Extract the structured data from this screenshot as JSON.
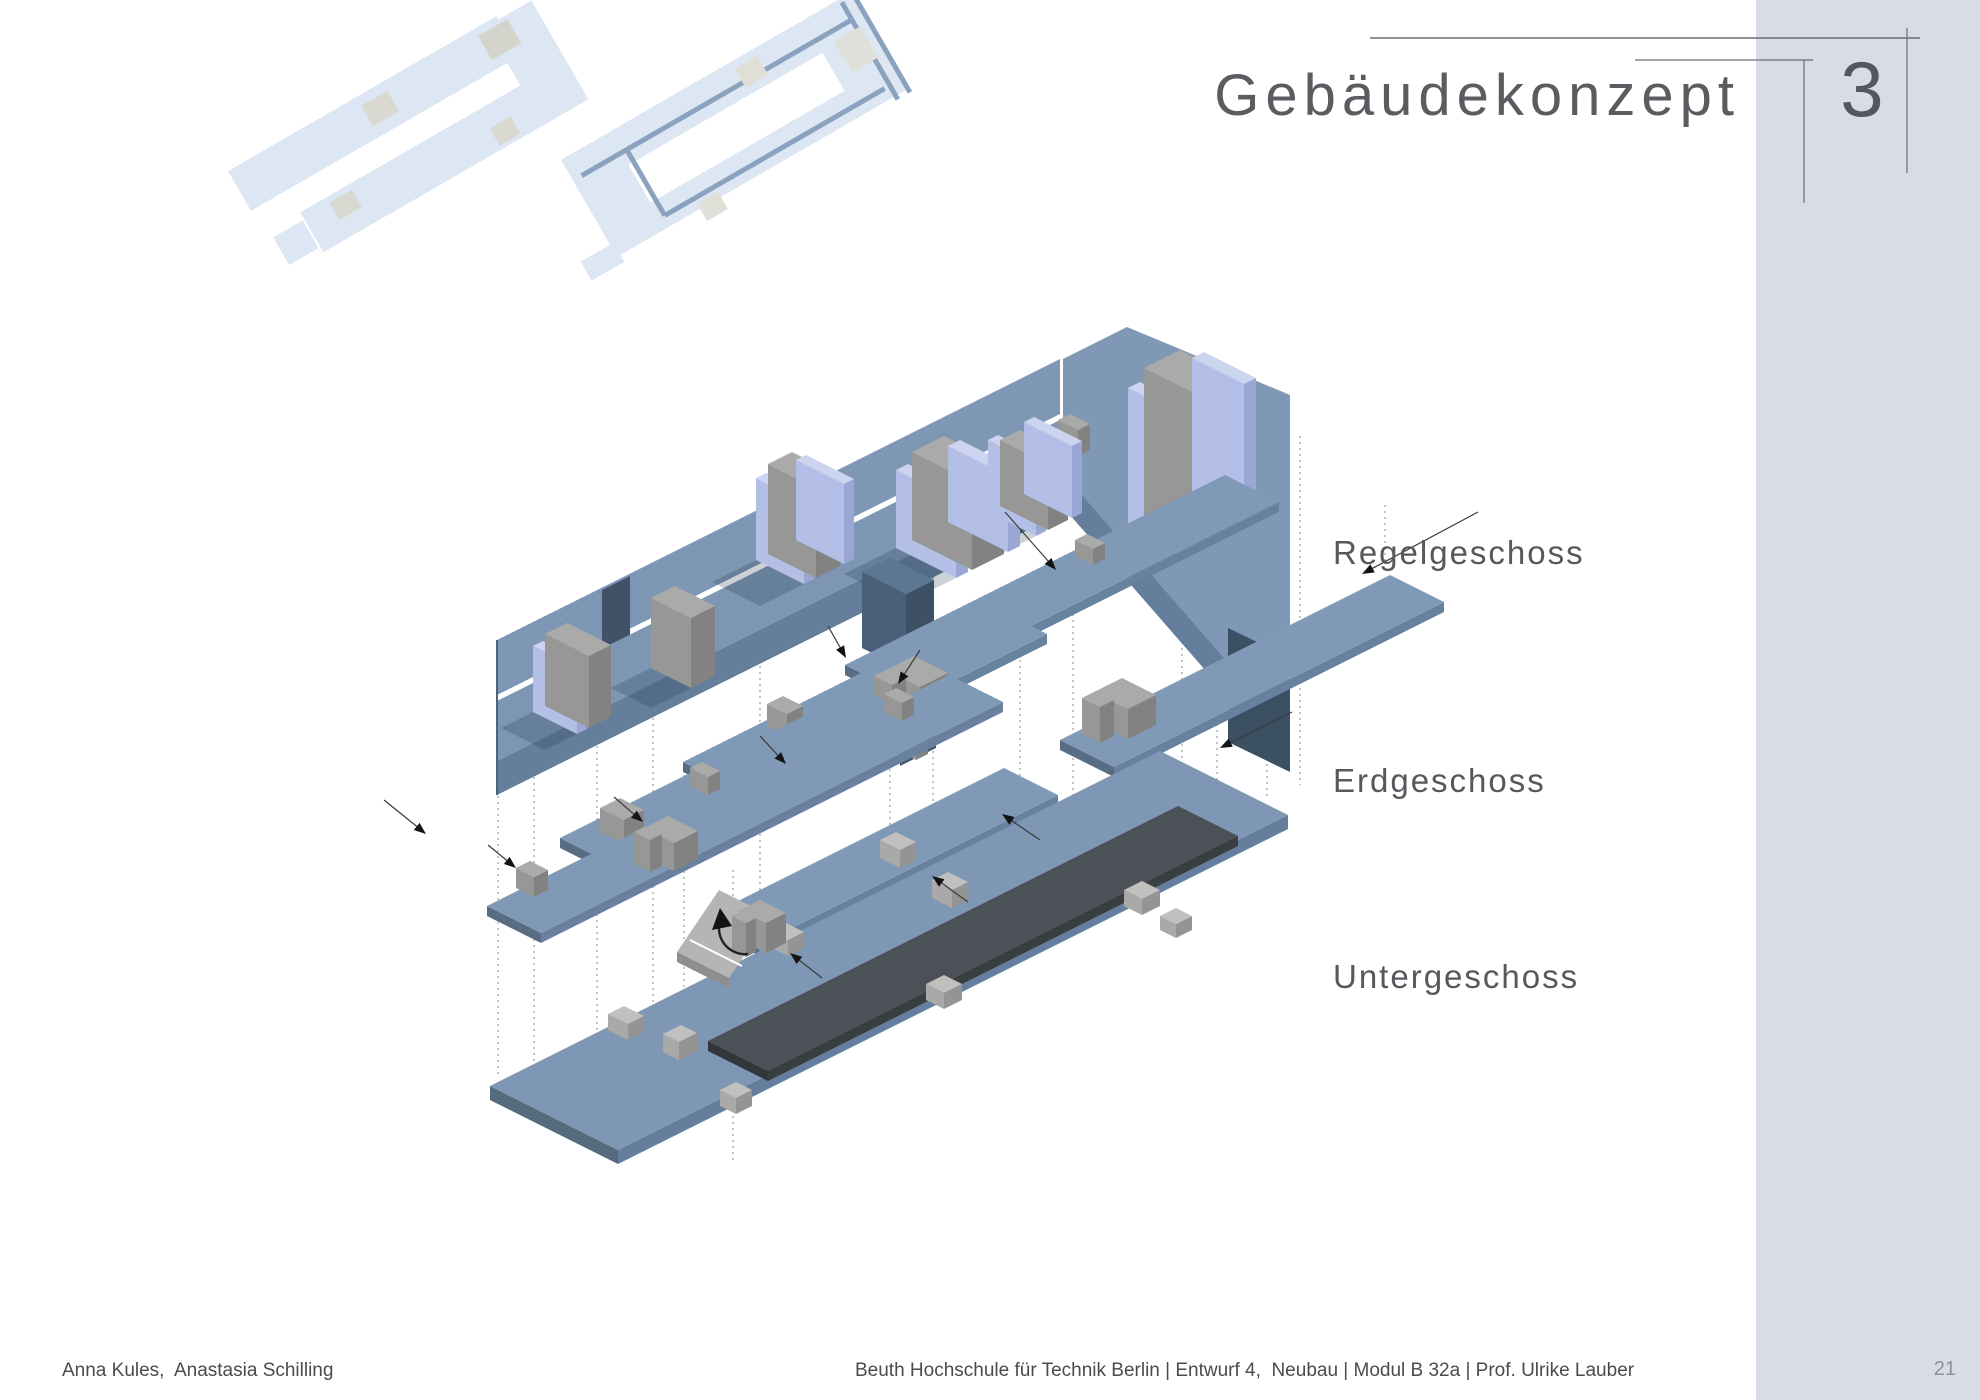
{
  "header": {
    "title": "Gebäudekonzept",
    "section_number": "3"
  },
  "diagram": {
    "labels": [
      {
        "id": "regelgeschoss",
        "label": "Regelgeschoss"
      },
      {
        "id": "erdgeschoss",
        "label": "Erdgeschoss"
      },
      {
        "id": "untergeschoss",
        "label": "Untergeschoss"
      }
    ],
    "thumbnails": [
      {
        "icon": "upper-floor-plan-icon"
      },
      {
        "icon": "ground-floor-plan-icon"
      }
    ]
  },
  "footer": {
    "authors": "Anna Kules,  Anastasia Schilling",
    "institution": "Beuth Hochschule für Technik Berlin | Entwurf 4,  Neubau | Modul B 32a | Prof. Ulrike Lauber",
    "page_number": "21"
  },
  "colors": {
    "sidebar_gray": "#d9dce6",
    "slab_blue": "#7e97b5",
    "slab_front_blue": "#647e9b",
    "wall_blue": "#7f98b6",
    "periwinkle": "#aebbe3",
    "core_gray": "#9fa09e",
    "dark_plate": "#4c5157",
    "hanging_dark_blue": "#3f5268",
    "plan_light_blue": "#dce7f3",
    "plan_corridor_blue": "#8ba2be",
    "text_dark": "#55585c",
    "footer_text": "#4b4b4b",
    "page_number_gray": "#8e919b"
  }
}
